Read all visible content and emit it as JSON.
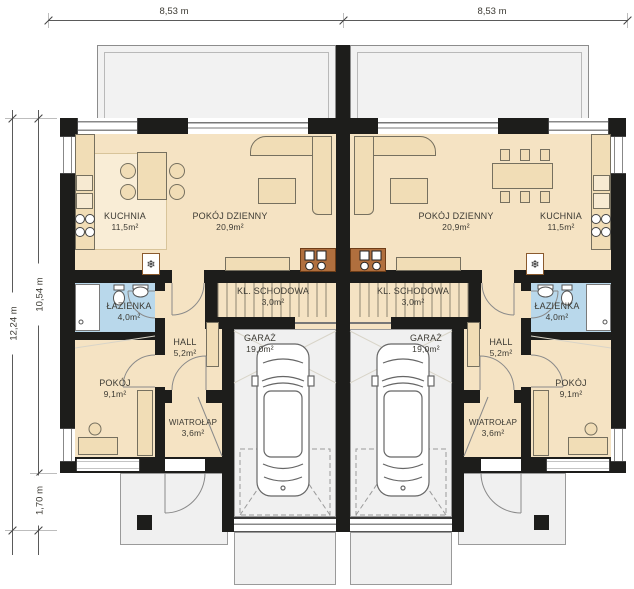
{
  "plan_title": "parter-floor-plan-duplex",
  "dimensions": {
    "top_left": "8,53 m",
    "top_right": "8,53 m",
    "side_outer": "12,24 m",
    "side_inner": "10,54 m",
    "side_porch": "1,70 m"
  },
  "rooms": {
    "kuchnia": {
      "name": "KUCHNIA",
      "area": "11,5m²"
    },
    "pokoj_dzienny": {
      "name": "POKÓJ DZIENNY",
      "area": "20,9m²"
    },
    "kl_schodowa": {
      "name": "KL. SCHODOWA",
      "area": "3,0m²"
    },
    "garaz": {
      "name": "GARAŻ",
      "area": "19,0m²"
    },
    "hall": {
      "name": "HALL",
      "area": "5,2m²"
    },
    "lazienka": {
      "name": "ŁAZIENKA",
      "area": "4,0m²"
    },
    "pokoj": {
      "name": "POKÓJ",
      "area": "9,1m²"
    },
    "wiatrolap": {
      "name": "WIATROŁAP",
      "area": "3,6m²"
    }
  },
  "icons": {
    "hvac": "❄"
  },
  "colors": {
    "wall": "#1d1d1b",
    "floor": "#f5e3c3",
    "floor_light": "#f9edd6",
    "bathroom": "#b9d8eb",
    "counter_brown": "#b06f3e",
    "paving": "#f0f0f0",
    "dimension": "#5a5a5a"
  }
}
